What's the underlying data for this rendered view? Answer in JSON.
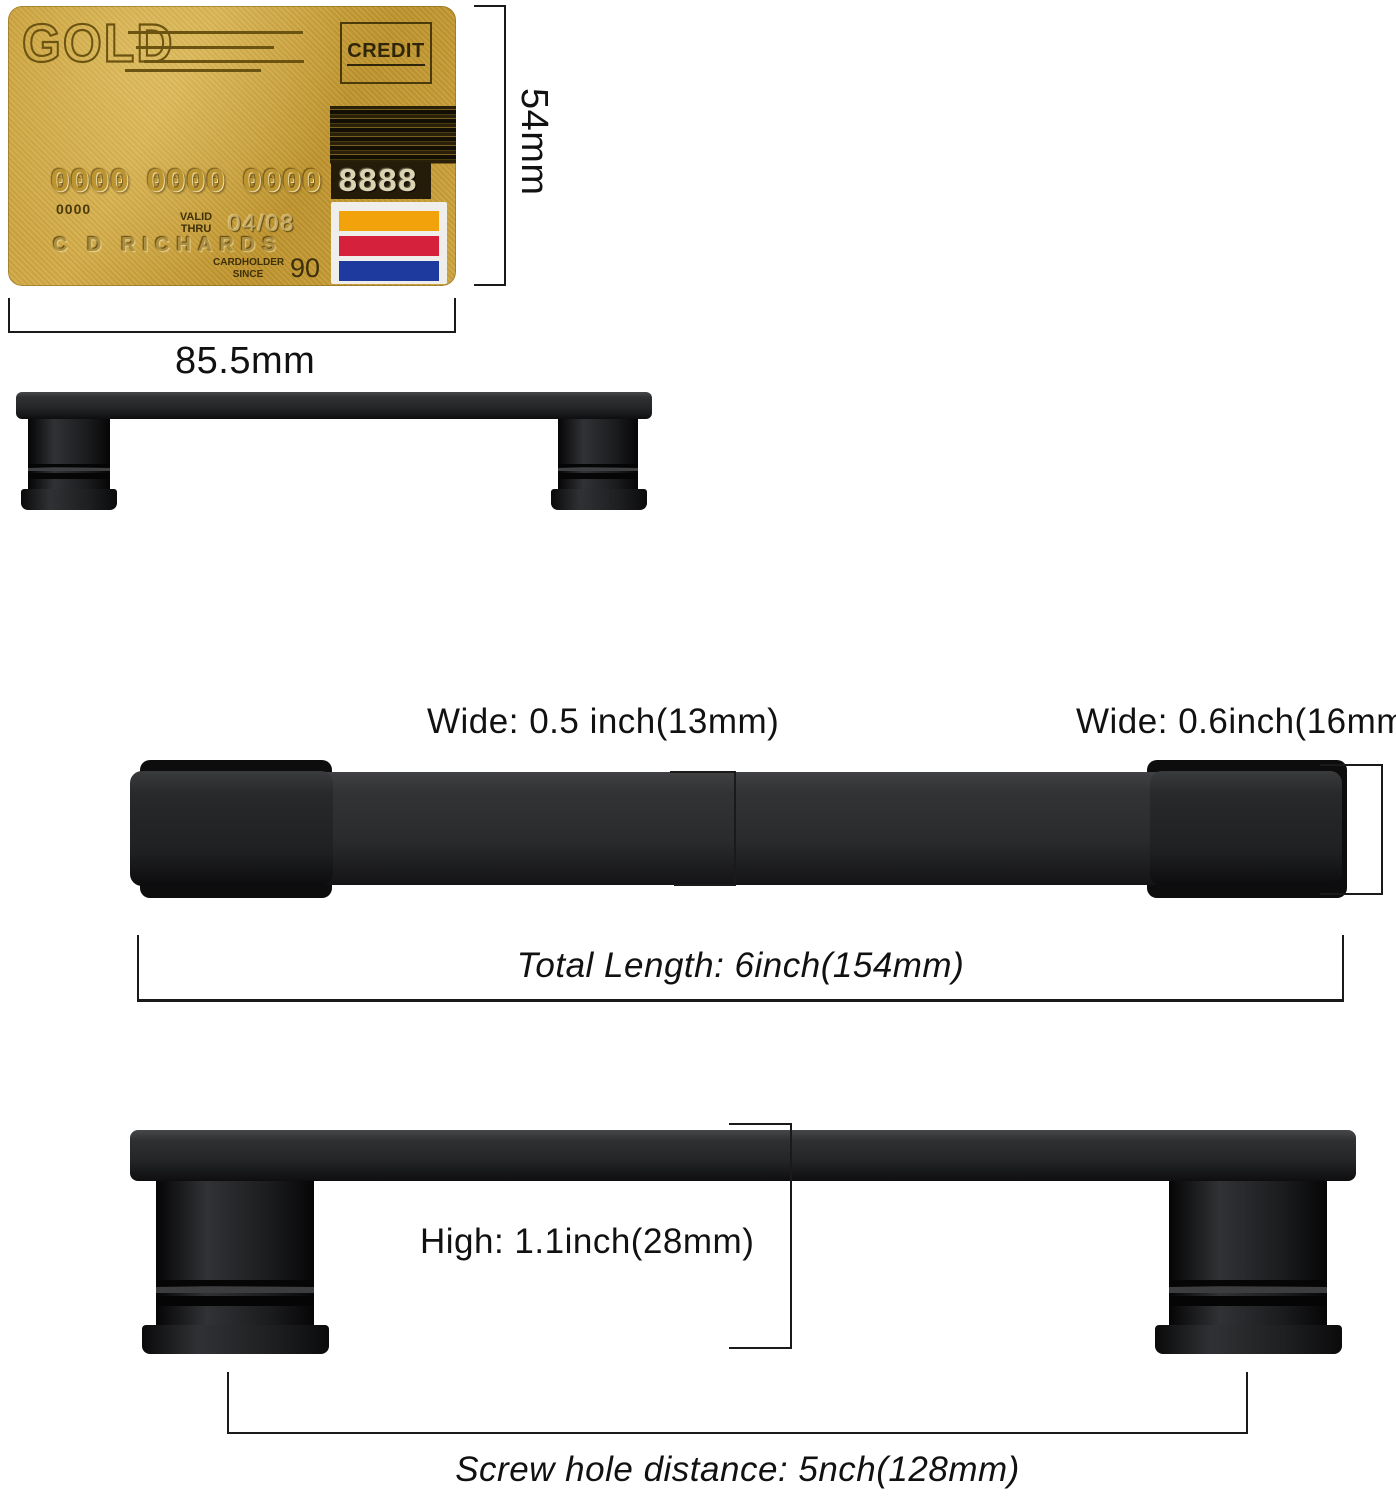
{
  "card": {
    "brand": "GOLD",
    "type_label": "CREDIT",
    "number_groups": [
      "0000",
      "0000",
      "0000",
      "8888"
    ],
    "account_number_small": "0000",
    "valid_line1": "VALID",
    "valid_line2": "THRU",
    "valid_value": "04/08",
    "holder_name": "C D RICHARDS",
    "since_line1": "CARDHOLDER",
    "since_line2": "SINCE",
    "since_value": "90",
    "gold_color": "#c89d35",
    "stripes": [
      {
        "name": "orange",
        "style": "background:#f2a30b"
      },
      {
        "name": "red",
        "style": "background:#d5213b"
      },
      {
        "name": "blue",
        "style": "background:#1f3a9e"
      }
    ]
  },
  "dimensions": {
    "card_height": "54mm",
    "card_width": "85.5mm",
    "bar_wide": "Wide: 0.5 inch(13mm)",
    "cap_wide": "Wide: 0.6inch(16mm)",
    "total_length": "Total Length: 6inch(154mm)",
    "height": "High: 1.1inch(28mm)",
    "screw_hole_distance": "Screw hole distance: 5nch(128mm)"
  },
  "handle_color": "#1c1d1f",
  "line_color": "#1a1a1a"
}
